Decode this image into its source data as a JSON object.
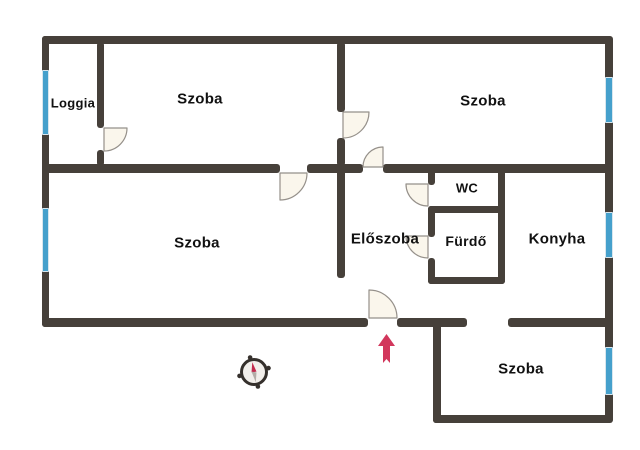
{
  "plan": {
    "type": "apartment-floorplan",
    "language": "Hungarian",
    "rooms": {
      "loggia": {
        "label": "Loggia"
      },
      "szoba_top_left": {
        "label": "Szoba"
      },
      "szoba_top_right": {
        "label": "Szoba"
      },
      "szoba_main": {
        "label": "Szoba"
      },
      "eloszoba": {
        "label": "Előszoba"
      },
      "wc": {
        "label": "WC"
      },
      "furdo": {
        "label": "Fürdő"
      },
      "konyha": {
        "label": "Konyha"
      },
      "szoba_bottom": {
        "label": "Szoba"
      }
    },
    "colors": {
      "wall": "#46403a",
      "window": "#45a0cc",
      "door_fill": "#faf6ec",
      "door_stroke": "#95908a",
      "entrance_arrow": "#d2375c",
      "compass_needle_north": "#c22a4d",
      "compass_needle_south": "#b3ada7",
      "background": "#ffffff",
      "text": "#111111"
    },
    "counts": {
      "windows": 5,
      "door_arcs": 7,
      "open_passages": 2
    },
    "annotations": {
      "entrance_arrow": "entrance direction (points into Előszoba)",
      "compass": "compass rose, red needle toward upper-left (north)"
    }
  }
}
